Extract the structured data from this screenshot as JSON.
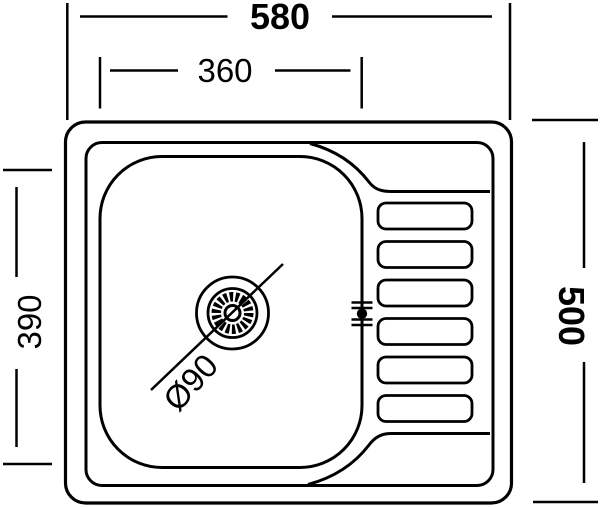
{
  "diagram": {
    "type": "technical-drawing",
    "subject": "kitchen sink with bowl, drain and drainboard, top view",
    "background_color": "#ffffff",
    "line_color": "#000000",
    "dimensions": {
      "overall_width": "580",
      "bowl_width": "360",
      "bowl_depth": "390",
      "overall_depth": "500",
      "drain_diameter": "Ø90"
    },
    "drainboard": {
      "slot_count": 6
    }
  }
}
